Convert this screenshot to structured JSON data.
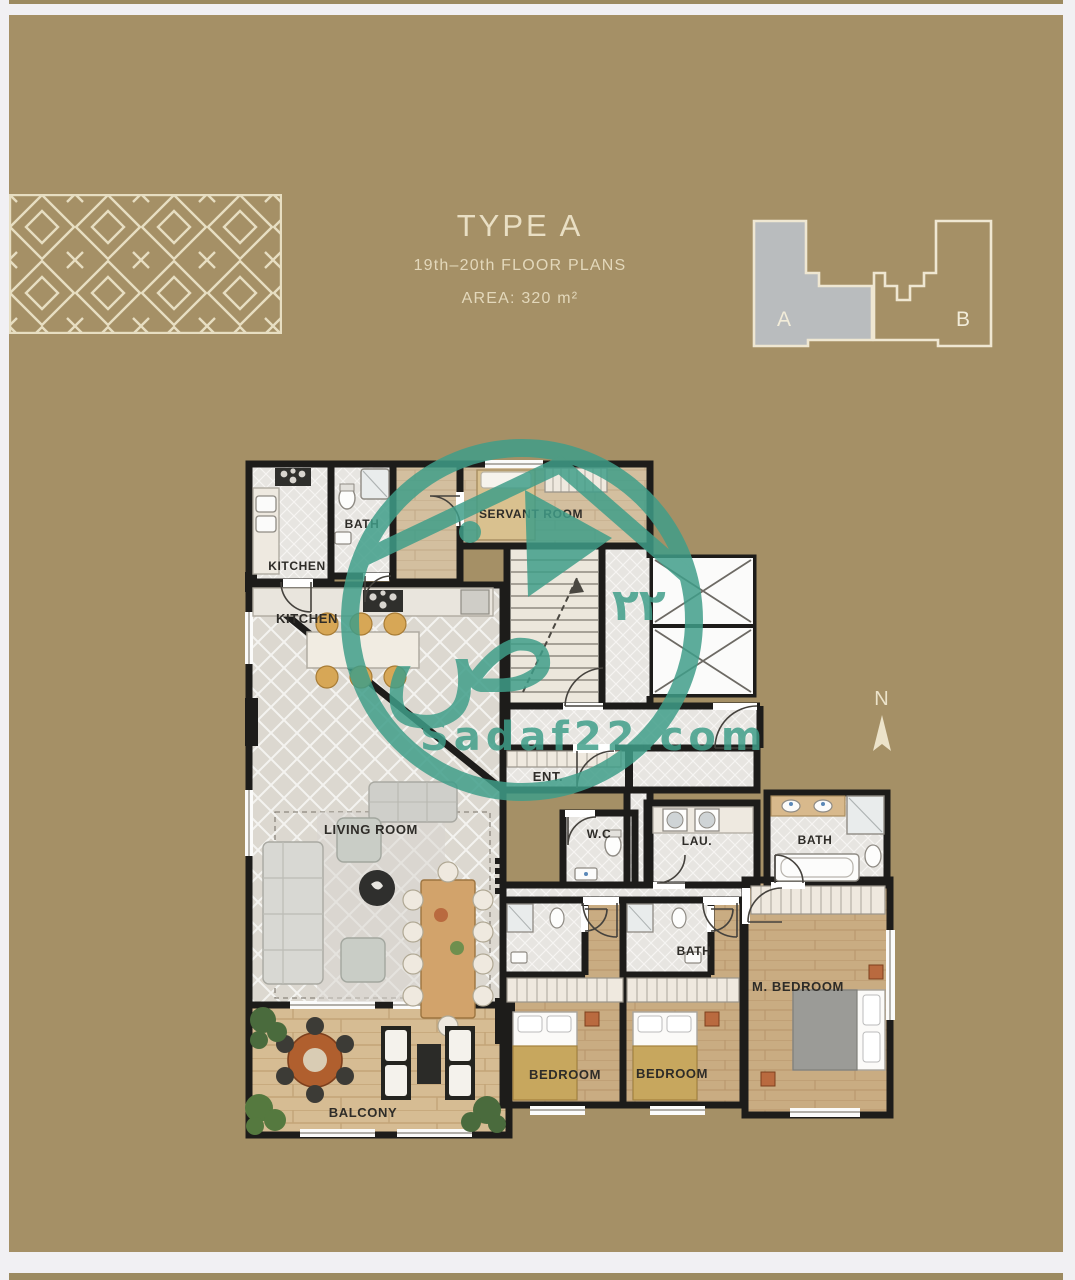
{
  "colors": {
    "background": "#a59066",
    "frame": "#f1f0f3",
    "text_cream": "#e9dfc4",
    "wall": "#1d1c1a",
    "watermark_teal": "#3f9e89",
    "keyplan_highlight": "#b9bcbe"
  },
  "header": {
    "type_label": "TYPE A",
    "floors_label": "19th–20th FLOOR PLANS",
    "area_label": "AREA: 320 m²"
  },
  "keyplan": {
    "unit_a_label": "A",
    "unit_b_label": "B"
  },
  "compass": {
    "north_label": "N"
  },
  "watermark": {
    "site": "Sadaf22.com",
    "number_arabic": "٢٢",
    "letter_arabic": "ص"
  },
  "plan": {
    "rooms": [
      {
        "id": "kitchen-small",
        "label": "KITCHEN"
      },
      {
        "id": "bath-servant",
        "label": "BATH"
      },
      {
        "id": "servant-room",
        "label": "SERVANT ROOM"
      },
      {
        "id": "kitchen-main",
        "label": "KITCHEN"
      },
      {
        "id": "living-room",
        "label": "LIVING ROOM"
      },
      {
        "id": "entrance",
        "label": "ENT."
      },
      {
        "id": "wc",
        "label": "W.C"
      },
      {
        "id": "laundry",
        "label": "LAU."
      },
      {
        "id": "bath-master",
        "label": "BATH"
      },
      {
        "id": "bath-middle",
        "label": "BATH"
      },
      {
        "id": "bedroom-1",
        "label": "BEDROOM"
      },
      {
        "id": "bedroom-2",
        "label": "BEDROOM"
      },
      {
        "id": "master-bedroom",
        "label": "M. BEDROOM"
      },
      {
        "id": "balcony",
        "label": "BALCONY"
      }
    ]
  }
}
